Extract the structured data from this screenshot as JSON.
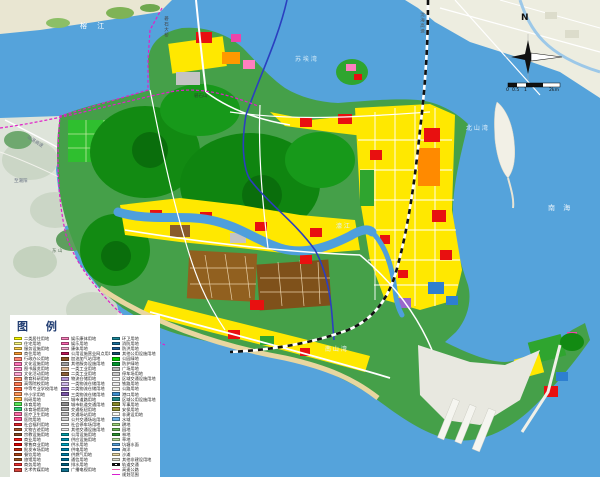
{
  "legend": {
    "title": "图 例",
    "columns": [
      {
        "items": [
          {
            "c": "#FFFF00",
            "t": "二类居住用地"
          },
          {
            "c": "#FFFA80",
            "t": "住宅用地"
          },
          {
            "c": "#FFD24D",
            "t": "服务设施用地"
          },
          {
            "c": "#FF9E33",
            "t": "商住用地"
          },
          {
            "c": "#FF8573",
            "t": "行政办公用地"
          },
          {
            "c": "#FF73B8",
            "t": "文化设施用地"
          },
          {
            "c": "#FF8CC6",
            "t": "图书展览用地"
          },
          {
            "c": "#FFA6D2",
            "t": "文化活动用地"
          },
          {
            "c": "#FF8A66",
            "t": "教育科研用地"
          },
          {
            "c": "#FF7A52",
            "t": "高等院校用地"
          },
          {
            "c": "#FF6B42",
            "t": "中等专业学校用地"
          },
          {
            "c": "#FF9655",
            "t": "中小学用地"
          },
          {
            "c": "#FFAE3D",
            "t": "科研用地"
          },
          {
            "c": "#57E857",
            "t": "体育用地"
          },
          {
            "c": "#2ECC71",
            "t": "体育场馆用地"
          },
          {
            "c": "#FF6FA8",
            "t": "医疗卫生用地"
          },
          {
            "c": "#FF4F94",
            "t": "医院用地"
          },
          {
            "c": "#E8262D",
            "t": "社会福利用地"
          },
          {
            "c": "#A8552A",
            "t": "文物古迹用地"
          },
          {
            "c": "#8A4A22",
            "t": "宗教设施用地"
          },
          {
            "c": "#FF1A1A",
            "t": "商业用地"
          },
          {
            "c": "#E60000",
            "t": "零售商业用地"
          },
          {
            "c": "#C62D12",
            "t": "批发市场用地"
          },
          {
            "c": "#B04515",
            "t": "餐饮用地"
          },
          {
            "c": "#9E5520",
            "t": "旅馆用地"
          },
          {
            "c": "#F03030",
            "t": "商务用地"
          },
          {
            "c": "#D8453C",
            "t": "艺术传媒用地"
          }
        ]
      },
      {
        "items": [
          {
            "c": "#FF80BF",
            "t": "娱乐康体用地"
          },
          {
            "c": "#FF66B3",
            "t": "娱乐用地"
          },
          {
            "c": "#F5A9D0",
            "t": "康体用地"
          },
          {
            "c": "#C2185B",
            "t": "公用设施营业网点用地"
          },
          {
            "c": "#8D5524",
            "t": "加油加气站用地"
          },
          {
            "c": "#9E9E9E",
            "t": "其他服务设施用地"
          },
          {
            "c": "#D9B896",
            "t": "一类工业用地"
          },
          {
            "c": "#8C6239",
            "t": "二类工业用地"
          },
          {
            "c": "#B399D9",
            "t": "物流仓储用地"
          },
          {
            "c": "#CDB8E8",
            "t": "一类物流仓储用地"
          },
          {
            "c": "#9A79C9",
            "t": "二类物流仓储用地"
          },
          {
            "c": "#7B57A8",
            "t": "三类物流仓储用地"
          },
          {
            "c": "#FFFFFF",
            "t": "城市道路用地"
          },
          {
            "c": "#8F8F8F",
            "t": "城市轨道交通用地"
          },
          {
            "c": "#A9A9A9",
            "t": "交通枢纽用地"
          },
          {
            "c": "#BDBDBD",
            "t": "交通场站用地"
          },
          {
            "c": "#CFCFCF",
            "t": "公共交通场站用地"
          },
          {
            "c": "#DEDEDE",
            "t": "社会停车场用地"
          },
          {
            "c": "#EAEAEA",
            "t": "其他交通设施用地"
          },
          {
            "c": "#009FA8",
            "t": "公用设施用地"
          },
          {
            "c": "#0094B3",
            "t": "供应设施用地"
          },
          {
            "c": "#00A8C6",
            "t": "供水用地"
          },
          {
            "c": "#0087B3",
            "t": "供电用地"
          },
          {
            "c": "#007FA8",
            "t": "供燃气用地"
          },
          {
            "c": "#00739E",
            "t": "通信用地"
          },
          {
            "c": "#006080",
            "t": "排水用地"
          },
          {
            "c": "#10718F",
            "t": "广播电视用地"
          }
        ]
      },
      {
        "items": [
          {
            "c": "#1B8A9E",
            "t": "环卫用地"
          },
          {
            "c": "#186F9E",
            "t": "消防用地"
          },
          {
            "c": "#1F5F9E",
            "t": "防洪用地"
          },
          {
            "c": "#16506F",
            "t": "其他公用设施用地"
          },
          {
            "c": "#00D200",
            "t": "公园绿地"
          },
          {
            "c": "#00962E",
            "t": "防护绿地"
          },
          {
            "c": "#B5B5B5",
            "t": "广场用地"
          },
          {
            "c": "#CCCCCC",
            "t": "停车场用地"
          },
          {
            "c": "#F5F5F5",
            "t": "区域交通设施用地"
          },
          {
            "c": "#ECECEC",
            "t": "铁路用地"
          },
          {
            "c": "#F0F0EA",
            "t": "公路用地"
          },
          {
            "c": "#3E8FD0",
            "t": "港口用地"
          },
          {
            "c": "#1F8A8A",
            "t": "区域公用设施用地"
          },
          {
            "c": "#8A8A28",
            "t": "军事用地"
          },
          {
            "c": "#9C9C3A",
            "t": "安保用地"
          },
          {
            "c": "#FAFAF5",
            "t": "非建设用地"
          },
          {
            "c": "#6FB5E8",
            "t": "水域"
          },
          {
            "c": "#9ED67A",
            "t": "耕地"
          },
          {
            "c": "#6FBF5A",
            "t": "园地"
          },
          {
            "c": "#2E9632",
            "t": "林地"
          },
          {
            "c": "#B5E09A",
            "t": "草地"
          },
          {
            "c": "#55A0DC",
            "t": "坑塘水面"
          },
          {
            "c": "#3F8FD9",
            "t": "海洋"
          },
          {
            "c": "#EAD9A5",
            "t": "沙滩"
          },
          {
            "c": "#DEDECE",
            "t": "其他非建设用地"
          },
          {
            "line": "rail",
            "t": "轨道交通"
          },
          {
            "line": "hwy",
            "t": "高速公路"
          },
          {
            "line": "bound",
            "t": "规划范围"
          }
        ]
      }
    ]
  },
  "map_labels": [
    {
      "t": "榕  江",
      "x": 80,
      "y": 23,
      "c": "#FFFFFF",
      "s": 7,
      "ls": 4
    },
    {
      "t": "礐石大桥",
      "x": 163,
      "y": 16,
      "c": "#444444",
      "s": 4.5,
      "v": true
    },
    {
      "t": "苏 埃 湾",
      "x": 295,
      "y": 57,
      "c": "#D7ECF8",
      "s": 6
    },
    {
      "t": "沈海高速",
      "x": 419,
      "y": 12,
      "c": "#555555",
      "s": 4.5,
      "v": true
    },
    {
      "t": "北 山 湾",
      "x": 466,
      "y": 126,
      "c": "#E8F3FB",
      "s": 6
    },
    {
      "t": "南  海",
      "x": 548,
      "y": 205,
      "c": "#E8F3FB",
      "s": 7,
      "ls": 3
    },
    {
      "t": "南 山 湾",
      "x": 325,
      "y": 347,
      "c": "#E8F3FB",
      "s": 6
    },
    {
      "t": "礐石山",
      "x": 194,
      "y": 95,
      "c": "#2B4A2B",
      "s": 4.5
    },
    {
      "t": "东 山",
      "x": 52,
      "y": 250,
      "c": "#5A705A",
      "s": 4.5
    },
    {
      "t": "汕湛高速",
      "x": 28,
      "y": 136,
      "c": "#707888",
      "s": 4.5,
      "r": 33
    },
    {
      "t": "至潮阳",
      "x": 14,
      "y": 180,
      "c": "#667080",
      "s": 4.5
    },
    {
      "t": "濠 江",
      "x": 336,
      "y": 224,
      "c": "#E0F0FA",
      "s": 6
    }
  ],
  "compass": {
    "north": "N"
  },
  "scale_bar": {
    "ticks": [
      {
        "t": "0",
        "x": 506
      },
      {
        "t": "0.5",
        "x": 512
      },
      {
        "t": "1",
        "x": 524
      },
      {
        "t": "2km",
        "x": 549
      }
    ],
    "y": 88
  },
  "colors": {
    "sea": "#55A3DB",
    "boundary": "#E020C8",
    "railway": "#111111",
    "expressway": "#2B3FBF",
    "hill_base": "#DEE4DA",
    "urban_yellow": "#FFE800",
    "park_green": "#128A12",
    "industrial_brown": "#8A5B2B",
    "commercial_red": "#E81010"
  }
}
